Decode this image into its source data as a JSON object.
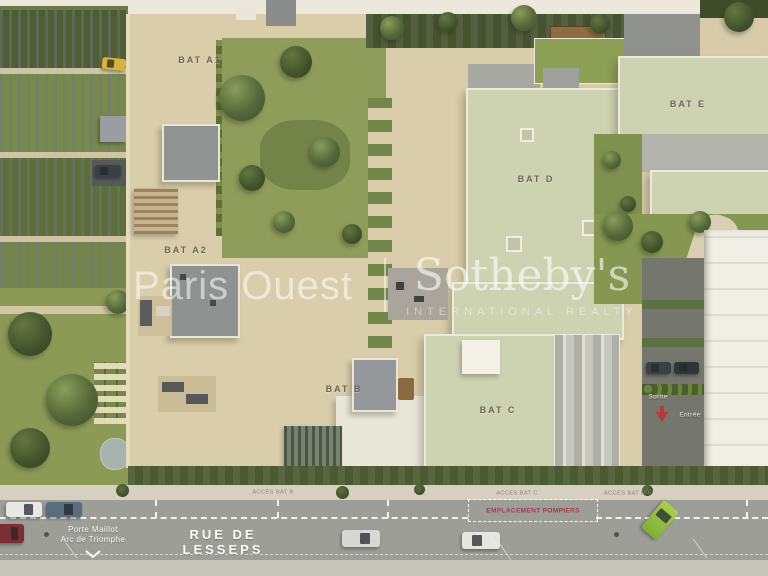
{
  "scene_title": "Aerial site plan — residential development",
  "buildings": [
    {
      "id": "bat-a1",
      "label": "BAT A1"
    },
    {
      "id": "bat-a2",
      "label": "BAT A2"
    },
    {
      "id": "bat-b",
      "label": "BAT B"
    },
    {
      "id": "bat-c",
      "label": "BAT C"
    },
    {
      "id": "bat-d",
      "label": "BAT D"
    },
    {
      "id": "bat-e",
      "label": "BAT E"
    }
  ],
  "street": {
    "name": "RUE DE LESSEPS",
    "direction": [
      "Porte Maillot",
      "Arc de Triomphe"
    ],
    "fire_lane": "EMPLACEMENT POMPIERS",
    "access": [
      "ACCÈS BAT B",
      "ACCÈS BAT C",
      "ACCÈS BAT D-E"
    ]
  },
  "parking_ramp": {
    "exit": "Sortie",
    "entry": "Entrée"
  },
  "watermark": {
    "left": "Paris Ouest",
    "right": "Sotheby's",
    "subtitle": "INTERNATIONAL REALTY"
  },
  "colors": {
    "fire_lane_red": "#a43a44",
    "roof_sage": "#cdd2b0",
    "grass_green": "#8b9b56",
    "hedge_dark": "#46532f",
    "asphalt_gray": "#9e9e99",
    "deck_tan": "#d9cdaa",
    "watermark_white": "rgba(255,255,255,0.55)"
  }
}
